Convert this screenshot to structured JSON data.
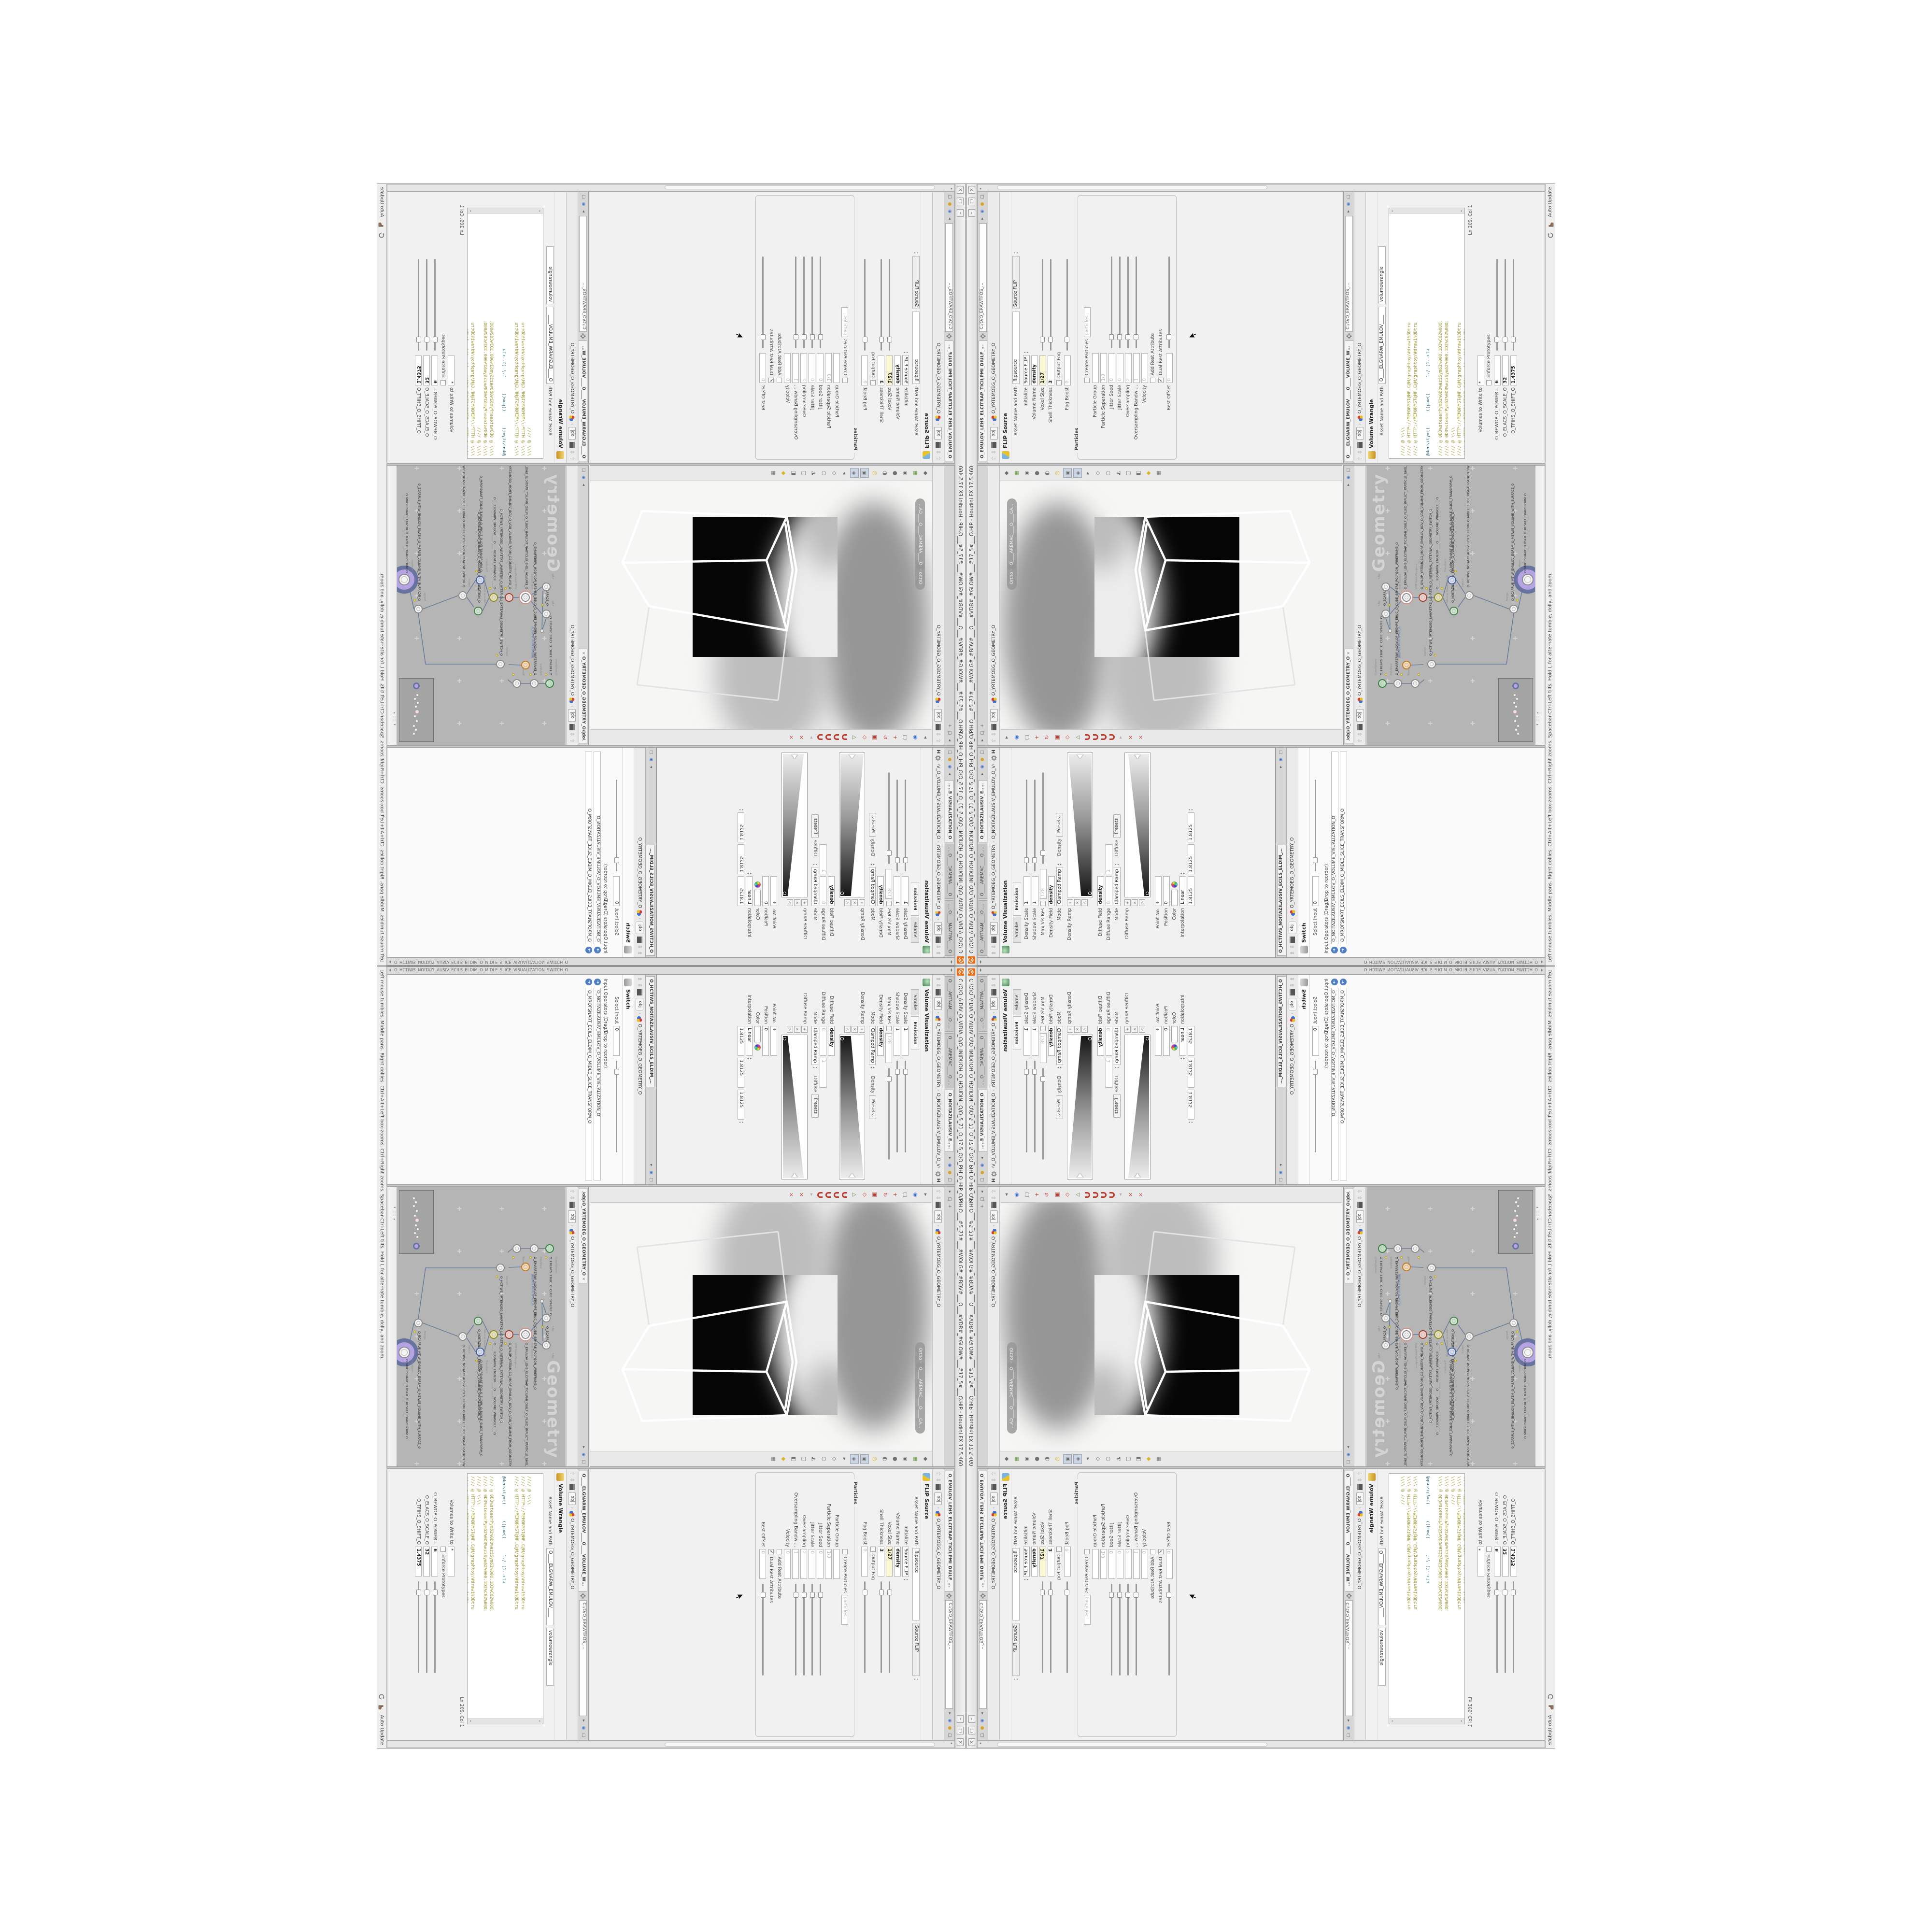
{
  "window": {
    "title": "C:/O/O_AIDIV_O_VIDIA_O/O_INIDUOH_O_HOUDINI_O/O_5_71_O_17.5_O/O_PIH_O_HIP_O/PIH.O___#5_71#___#WOLG#_#BDV#___O___#VDB#_#GLOW#___#17_5#___O.HIP - Houdini FX 17.5.460",
    "btn_min": "–",
    "btn_restore": "▢",
    "btn_close": "×"
  },
  "status": {
    "help": "Left mouse tumbles. Middle pans. Right dollies. Ctrl+Alt+Left box-zooms. Ctrl+Right zooms. Spacebar-Ctrl-Left tilts. Hold L for alternate tumble, dolly, and zoom.",
    "update_mode": "Auto Update"
  },
  "stowbar": {
    "left": "O_HCTIWS_NOITAZILAUSIV_ECILS_ELDIM_O_MIDLE_SLICE_VISUALIZATION_SWITCH_O"
  },
  "crumb": {
    "root": "obj",
    "geo": "O_YRTEMOEG_O_GEOMETRY_O"
  },
  "viz": {
    "tabs": [
      {
        "label": "O____ARTNAM____O...",
        "x": "×"
      },
      {
        "label": "O____AREMAC____O...",
        "x": "×"
      },
      {
        "label": "O_NOITAZILAUSIV_E...",
        "x": "×",
        "cls": "active"
      }
    ],
    "node_chip": "O_NOITAZILAUSIV_EMULOV_O_VO...",
    "header": "Volume Visualization",
    "subtab_smoke": "Smoke",
    "subtab_emission": "Emission",
    "params1": [
      {
        "label": "Density Scale",
        "value": "1",
        "slider": 1
      },
      {
        "label": "Shadow Scale",
        "value": "1",
        "slider": 1
      },
      {
        "label": "Max Vis Res",
        "value": "128",
        "cls": "grey",
        "slider": 1,
        "haschk": 1,
        "check": ""
      },
      {
        "label": "Density Field",
        "value": "density",
        "cls": "bold"
      },
      {
        "label": "Mode",
        "value": "Clamped Ramp",
        "combo": 1,
        "extra": "Density",
        "btn": "Presets"
      }
    ],
    "ramp1_label": "Density Ramp",
    "params2": [
      {
        "label": "Diffuse Field",
        "value": "density",
        "cls": "bold"
      },
      {
        "label": "Diffuse Range",
        "value": "0",
        "value2": "1",
        "cls": "grey"
      },
      {
        "label": "Mode",
        "value": "Clamped Ramp",
        "combo": 1,
        "extra": "Diffuse",
        "btn": "Presets"
      }
    ],
    "ramp2_label": "Diffuse Ramp",
    "params3": [
      {
        "label": "Point No.",
        "value": "1"
      },
      {
        "label": "Position",
        "value": "0"
      },
      {
        "label": "Color",
        "swatch": 1
      },
      {
        "label": "Interpolation",
        "value": "Linear",
        "combo": 1
      },
      {
        "label": "",
        "value": "1.8125",
        "value2": "1.8125",
        "value3": "1.8125",
        "combo": 1
      }
    ]
  },
  "switchpane": {
    "tab": "O_HCTIWS_NOITAZILAUSIV_ECILS_ELDIM_O_",
    "x": "×",
    "header": "Switch",
    "params": [
      {
        "label": "Select Input",
        "value": "0",
        "slider": 1
      }
    ],
    "list_title": "Input Operators (Drag/Drop to reorder)",
    "op_glyph": "➜",
    "inputs": [
      {
        "label": "O_NOITAZILAUSIV_EMULOV_O_VOLUME_VISUALIZATION_O"
      },
      {
        "label": "O_MROFSNART_ECILS_ELDIM_O_MIDLE_SLICE_TRANSFORM_O"
      }
    ]
  },
  "viewport": {
    "cam_pill": "O____AREMAC____O____CA...",
    "ortho_pill": "Ortho ▾",
    "toolbar_left": [
      {
        "g": "▸"
      },
      {
        "g": "◉",
        "cls": "c-blue"
      },
      {
        "g": "▢"
      },
      {
        "g": "+",
        "cls": "c-red"
      },
      {
        "g": "↻",
        "cls": "c-red"
      },
      {
        "g": "▣",
        "cls": "c-red"
      },
      {
        "g": "◇",
        "cls": "c-red"
      },
      {
        "g": "△",
        "cls": "c-green"
      },
      {
        "g": "",
        "cls": "magnet"
      },
      {
        "g": "",
        "cls": "magnet"
      },
      {
        "g": "",
        "cls": "magnet"
      },
      {
        "g": "",
        "cls": "magnet"
      },
      {
        "g": "▸",
        "cls": "dim"
      },
      {
        "g": "×",
        "cls": "c-red"
      },
      {
        "g": "×",
        "cls": "c-red"
      }
    ],
    "toolbar_right": [
      {
        "g": "◆"
      },
      {
        "g": "▦",
        "cls": "c-green"
      },
      {
        "g": "◉"
      },
      {
        "g": "●"
      },
      {
        "g": "◐"
      },
      {
        "g": "◎",
        "cls": "c-yellow"
      },
      {
        "g": "▣",
        "cls": "hl"
      },
      {
        "g": "◈",
        "cls": "hl"
      },
      {
        "g": "▸"
      },
      {
        "g": "◇"
      },
      {
        "g": "○"
      },
      {
        "g": "◭"
      },
      {
        "g": "▢"
      },
      {
        "g": "◧"
      },
      {
        "g": "◆",
        "cls": "c-yellow"
      },
      {
        "g": "▦"
      }
    ]
  },
  "network": {
    "tab": "/obj/O_YRTEMOEG_O_GEOMETRY_O",
    "x": "×",
    "watermark": "Geometry",
    "file_label": "JBO.M03.PETS.TPOLS_O",
    "nodes": [
      {
        "t": "CubeSphere",
        "n": "O_EREHPS_EBUC_O_CUBE_SPHERE_O",
        "css": "left:118px;top:24px",
        "k": "k-green",
        "f": 1
      },
      {
        "t": "PolyWire",
        "n": "O_EMARFERIW_NOGYLOP_EREHPS_EBUC_O_CUBE_SPHERE_POLYGON_WIREFRAME_O",
        "css": "left:118px;top:56px",
        "k": "",
        "f": 1
      },
      {
        "t": "File",
        "n": "",
        "css": "left:156px;top:74px",
        "k": "k-orange",
        "f": 0
      },
      {
        "t": "Bound",
        "n": "",
        "css": "left:118px;top:92px",
        "k": "",
        "f": 1
      },
      {
        "t": "Switch",
        "n": "O_HCTIWS_YRTEMOEG_LANRETXE_LANRETNI_O_INTERNAL_EXTERNAL_GEOMETRY_SWITCH_O",
        "css": "left:158px;top:126px",
        "k": "",
        "f": 1
      },
      {
        "t": "Clip",
        "n": "O_ECAFRUS_...",
        "css": "left:262px;top:31px",
        "k": "",
        "f": 1
      },
      {
        "t": "Clip",
        "n": "",
        "css": "left:318px;top:31px",
        "k": "",
        "f": 0
      },
      {
        "t": "FLIP Source",
        "n": "O_EMULOV_LEHS_ELCITRAP_TICILPMI_DIULF_O_FLUID_IMPLICT_PARTICLE_SHEL_VOLUME_O",
        "css": "left:296px;top:74px",
        "k": "k-ring",
        "f": 0
      },
      {
        "t": "VDB from Polygons",
        "n": "O_GYLOP_YRTEMOEG_MORF_EMULOV_BDV_O_VDB_VOLUME_FROM_GEOMETRY_POLYGONS_O",
        "css": "left:296px;top:108px",
        "k": "k-red",
        "f": 1
      },
      {
        "t": "Volume Wrangle",
        "n": "O____ELGNARW_EMULOV____O____VOLUME_WRANGLE___O",
        "css": "left:296px;top:140px",
        "k": "k-olive",
        "f": 1
      },
      {
        "t": "Volume Visualization",
        "n": "O_NOITAZILAUSIV_EMULOV_O_VOLUME_VISUALIZATION_O",
        "css": "left:268px;top:172px",
        "k": "k-viz",
        "f": 0
      },
      {
        "t": "Transform",
        "n": "O_MROFSNART_ECILS_ELDIM_O_MIDLE_SLICE_TRANSFORM_O",
        "css": "left:332px;top:168px",
        "k": "k-blue",
        "f": 1
      },
      {
        "t": "Switch",
        "n": "O_HCTIWS_NOITAZILAUSIV_ECILS_ELDIM_O_MIDLE_SLICE_VISUALIZATION_SWITCH_O",
        "css": "left:300px;top:204px",
        "k": "",
        "f": 0
      },
      {
        "t": "Merge",
        "n": "O_ECAFRUS_HTIW_EMULOV_EGREM_O_MERGE_VOLUME_WITH_SURFACE_O",
        "css": "left:272px;top:296px",
        "k": "",
        "f": 1
      },
      {
        "t": "Transform",
        "n": "O_MROFSNART_TLUSER_O_RESULT_TRANSFORM_O",
        "css": "left:330px;top:322px",
        "k": "k-big",
        "f": 0
      }
    ]
  },
  "flip": {
    "tab": "O_EMULOV_LEHS_ELCITRAP_TICILPMI_DIULF_O_FLUID_IMPLICIT_PARTICLE...",
    "x": "×",
    "path": "C:/O/O_ERAWTFOS_...",
    "header": "FLIP Source",
    "asset_label": "Asset Name and Path",
    "asset_name": "flipsource",
    "asset_menu": "Source FLIP",
    "params": [
      {
        "label": "Initialize",
        "value": "Source FLIP",
        "combo": 1
      },
      {
        "label": "Volume Name",
        "value": "density",
        "cls": "bold"
      },
      {
        "label": "Voxel Size",
        "value": "1/27",
        "cls": "bold yellow",
        "slider": 1
      },
      {
        "label": "Shell Thickness",
        "value": "3",
        "cls": "bold",
        "slider": 1
      },
      {
        "label": "",
        "tgl": "Output Fog",
        "check": ""
      },
      {
        "label": "Fog Boost",
        "value": "0",
        "cls": "grey",
        "slider": 1
      }
    ],
    "group_title": "Particles",
    "group_params": [
      {
        "label": "",
        "tgl": "Create Particles",
        "tcls": "bold",
        "check": "",
        "value": "particles",
        "cls": "grey"
      },
      {
        "label": "Particle Group",
        "value": " ",
        "cls": "grey"
      },
      {
        "label": "Particle Separation",
        "value": "1/9",
        "cls": "grey"
      },
      {
        "label": "Jitter Seed",
        "value": "0",
        "cls": "grey",
        "slider": 1
      },
      {
        "label": "Jitter Scale",
        "value": "0",
        "cls": "grey",
        "slider": 1
      },
      {
        "label": "Oversampling",
        "value": "2",
        "cls": "grey",
        "slider": 1
      },
      {
        "label": "Oversampling Bandwi...",
        "value": "1",
        "cls": "grey",
        "slider": 1
      },
      {
        "label": "Velocity",
        "value": "0",
        "cls": "grey"
      },
      {
        "label": "",
        "tgl": "Add Rest Attribute",
        "check": ""
      },
      {
        "label": "",
        "tgl": "Dual Rest Attributes",
        "check": "✓"
      },
      {
        "label": "Rest Offset",
        "value": "0",
        "cls": "grey",
        "slider": 1
      }
    ]
  },
  "wrangle": {
    "tab": "O____ELGNARW_EMULOV____O____VOLUME_WRANGL...",
    "x": "×",
    "path": "C:/O/O_ERAWTFOS_...",
    "header": "Volume Wrangle",
    "asset_label": "Asset Name and Path",
    "asset_name": "O____ELGNARW_EMULOV____",
    "asset_name2": "volumewrangle",
    "code": [
      {
        "t": "//// @ \\\\\\\\"
      },
      {
        "t": "//// @ HTTP://MEMORYST@MP.C@M/graphtoy/#draw1%3Dtru"
      },
      {
        "t": "//// @ HTTP://MEMORYST@MP.C@M/graphtoy/#draw1%3Dtru"
      },
      {
        "t": " "
      },
      {
        "t": "@density=((      ((pow((      1./ (1.-cla",
        "cls": "expr"
      },
      {
        "t": " "
      },
      {
        "t": "//// @ 0D3%steserPym62%0D3%eziSym62%000.1D3%C62%000."
      },
      {
        "t": "//// @ 0D3%steserPym62%0D3%eziSym62%000.1D3%C62%000."
      },
      {
        "t": "//// @ \\\\\\\\"
      },
      {
        "t": "//// @ HTTP://MEMORYST@MP.C@M/graphtoy/#draw1%3Dtru"
      },
      {
        "t": "//// @ HTTP://MEMORYST@MP.C@M/graphtoy/#draw1%3Dtru"
      }
    ],
    "lncol": "Ln 209, Col 1",
    "params": [
      {
        "label": "Volumes to Write to",
        "value": "*"
      },
      {
        "label": "",
        "tgl": "Enforce Prototypes",
        "check": ""
      },
      {
        "label": "O_REWOP_O_POWER...",
        "value": "6",
        "cls": "bold",
        "slider": 1
      },
      {
        "label": "O_ELACS_O_SCALE_O",
        "value": "32",
        "cls": "bold",
        "slider": 1
      },
      {
        "label": "O_TFIHS_O_SHIFT_O",
        "value": "1.4375",
        "cls": "bold",
        "slider": 1
      }
    ]
  },
  "colors": {
    "accent_orange": "#f26b10",
    "network_bg": "#b5b5b5",
    "code_olive": "#9a9a2e",
    "display_node_purple": "#b5a3e4"
  }
}
